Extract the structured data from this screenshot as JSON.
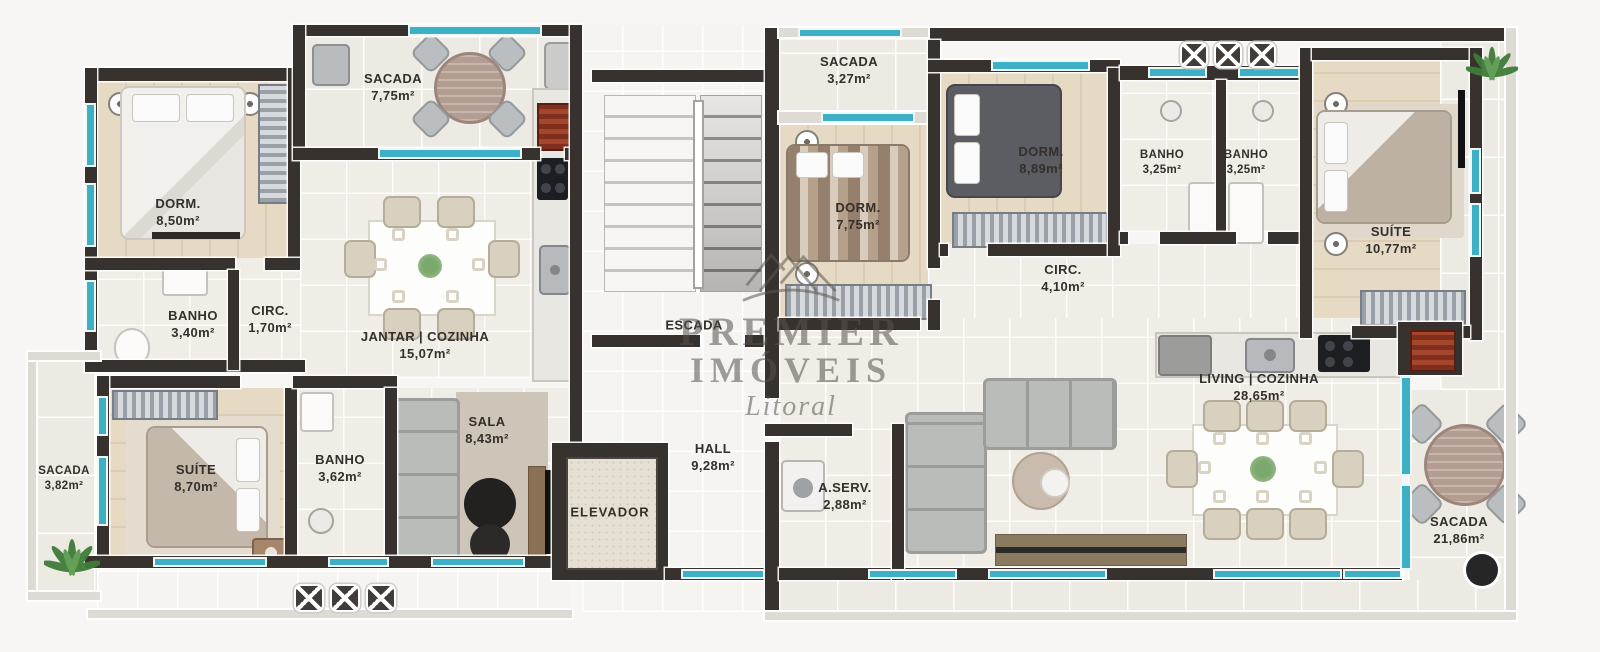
{
  "watermark": {
    "line1": "PREMIER",
    "line2": "IMÓVEIS",
    "line3": "Litoral"
  },
  "core": {
    "stairs": {
      "name": "ESCADA"
    },
    "elevator": {
      "name": "ELEVADOR"
    },
    "hall": {
      "name": "HALL",
      "area": "9,28m²"
    }
  },
  "left": {
    "sacada_top": {
      "name": "SACADA",
      "area": "7,75m²"
    },
    "dorm": {
      "name": "DORM.",
      "area": "8,50m²"
    },
    "banho_top": {
      "name": "BANHO",
      "area": "3,40m²"
    },
    "circ": {
      "name": "CIRC.",
      "area": "1,70m²"
    },
    "jantar": {
      "name": "JANTAR | COZINHA",
      "area": "15,07m²"
    },
    "sacada_left": {
      "name": "SACADA",
      "area": "3,82m²"
    },
    "suite": {
      "name": "SUÍTE",
      "area": "8,70m²"
    },
    "banho_bottom": {
      "name": "BANHO",
      "area": "3,62m²"
    },
    "sala": {
      "name": "SALA",
      "area": "8,43m²"
    }
  },
  "right": {
    "sacada_top": {
      "name": "SACADA",
      "area": "3,27m²"
    },
    "dorm1": {
      "name": "DORM.",
      "area": "7,75m²"
    },
    "dorm2": {
      "name": "DORM.",
      "area": "8,89m²"
    },
    "banho1": {
      "name": "BANHO",
      "area": "3,25m²"
    },
    "banho2": {
      "name": "BANHO",
      "area": "3,25m²"
    },
    "suite": {
      "name": "SUÍTE",
      "area": "10,77m²"
    },
    "circ": {
      "name": "CIRC.",
      "area": "4,10m²"
    },
    "living": {
      "name": "LIVING | COZINHA",
      "area": "28,65m²"
    },
    "aserv": {
      "name": "A.SERV.",
      "area": "2,88m²"
    },
    "sacada_right": {
      "name": "SACADA",
      "area": "21,86m²"
    }
  },
  "colors": {
    "wall": "#38322e",
    "window": "#3eb0c6",
    "floor": "#f0ece6",
    "wood": "#e7dac4"
  }
}
